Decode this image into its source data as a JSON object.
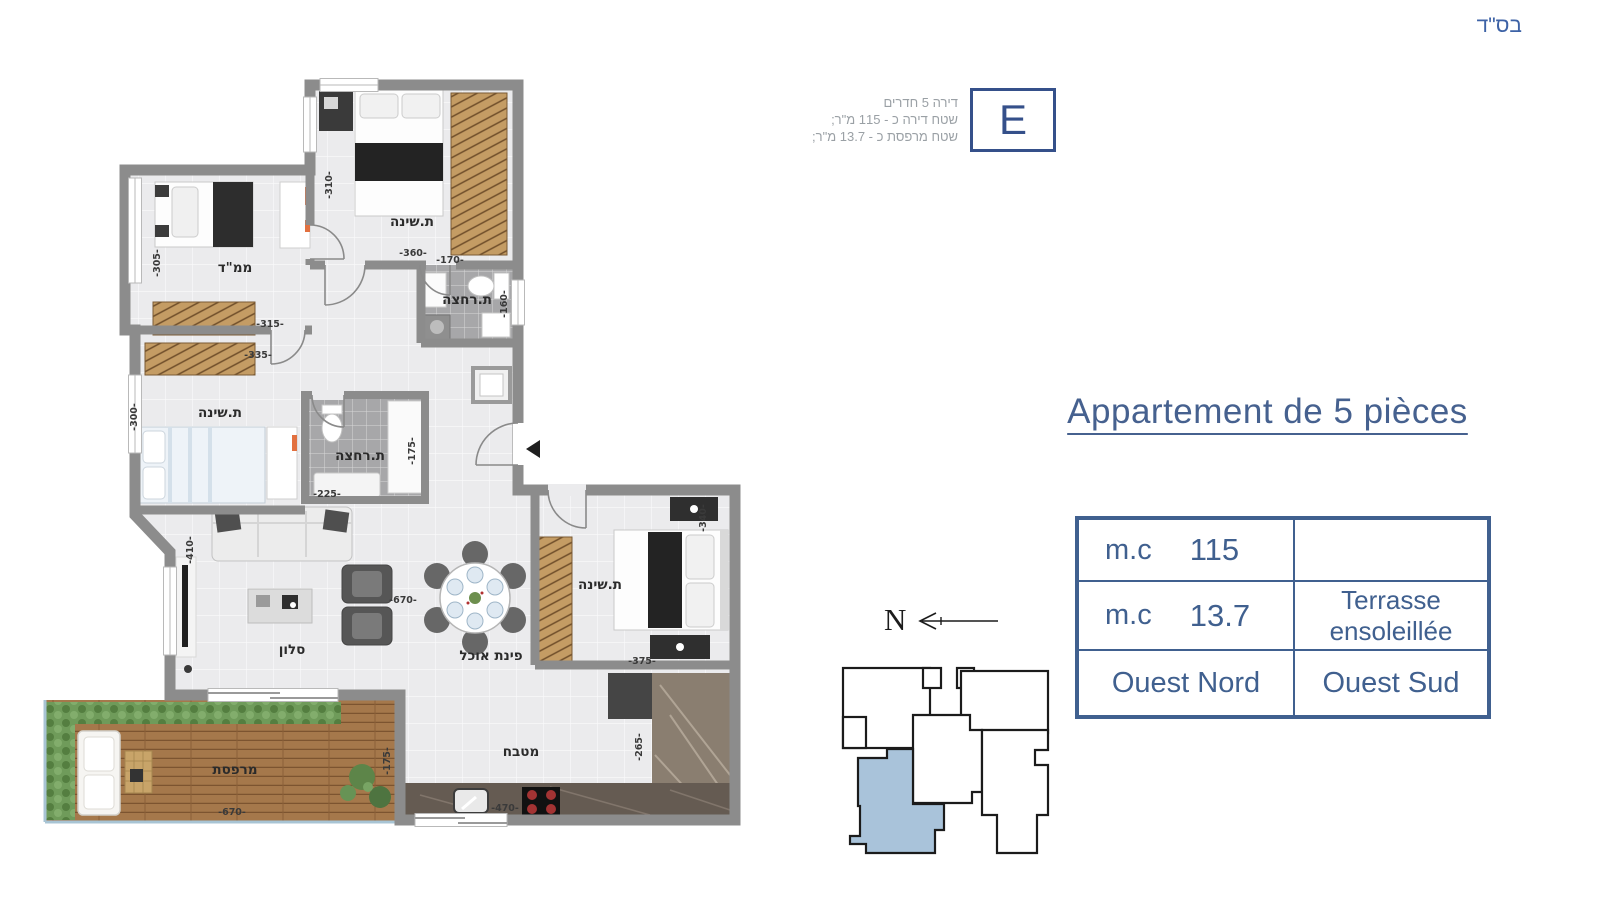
{
  "header": {
    "bsd": "בס\"ד"
  },
  "unit_info": {
    "lines": [
      "דירה 5 חדרים",
      "שטח דירה כ - 115 מ\"ר;",
      "שטח מרפסת כ - 13.7 מ\"ר;"
    ],
    "unit_letter": "E"
  },
  "title": {
    "text": "Appartement de 5 pièces"
  },
  "spec_table": {
    "rows": [
      {
        "left_label": "m.c",
        "left_value": "115",
        "right": ""
      },
      {
        "left_label": "m.c",
        "left_value": "13.7",
        "right_line1": "Terrasse",
        "right_line2": "ensoleillée"
      },
      {
        "left_full": "Ouest Nord",
        "right_full": "Ouest Sud"
      }
    ]
  },
  "compass": {
    "label": "N"
  },
  "plan": {
    "rooms": {
      "bedroom_top": "ת.שינה",
      "mamad": "ממ\"ד",
      "bathroom_top": "ת.רחצה",
      "bedroom_mid": "ת.שינה",
      "bathroom_mid": "ת.רחצה",
      "living": "סלון",
      "dining": "פינת אוכל",
      "kitchen": "מטבח",
      "bedroom_right": "ת.שינה",
      "terrace": "מרפסת"
    },
    "dims": {
      "d310": "-310-",
      "d360": "-360-",
      "d305": "-305-",
      "d315": "-315-",
      "d335": "-335-",
      "d300": "-300-",
      "d170": "-170-",
      "d160": "-160-",
      "d225": "-225-",
      "d175_bath": "-175-",
      "d410": "-410-",
      "d670_living": "-670-",
      "d340": "-340-",
      "d375": "-375-",
      "d265": "-265-",
      "d470": "-470-",
      "d670_terrace": "-670-",
      "d175_terrace": "-175-"
    }
  },
  "colors": {
    "accent_blue": "#40608f",
    "bsd_blue": "#3d62a6",
    "wall_gray": "#8c8c8c",
    "highlighted_unit": "#a9c3da"
  }
}
